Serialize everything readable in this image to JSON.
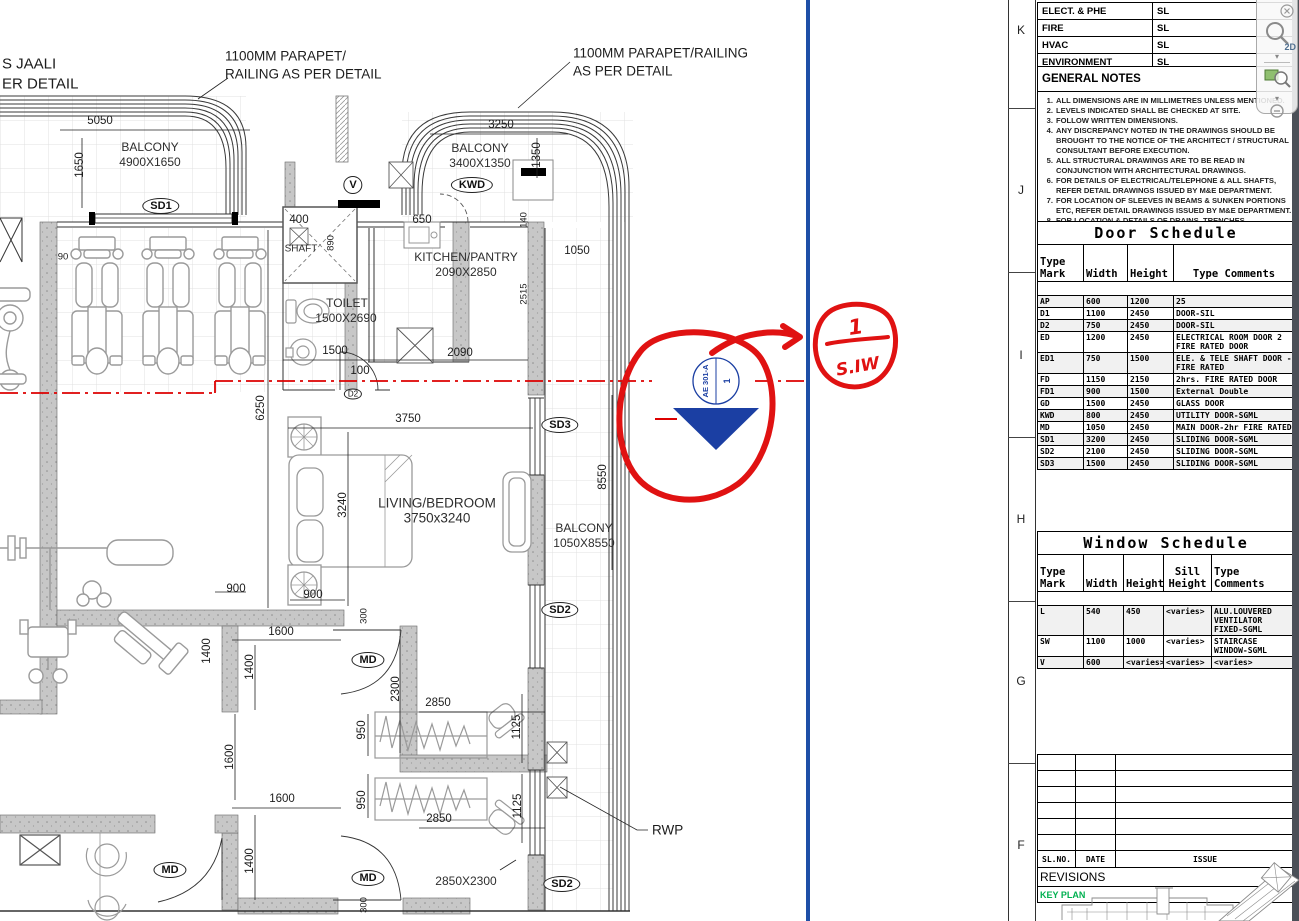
{
  "plan": {
    "labels": [
      "S JAALI",
      "ER DETAIL",
      "1100MM PARAPET/",
      "RAILING AS PER DETAIL",
      "1100MM PARAPET/RAILING",
      "AS PER DETAIL",
      "5050",
      "BALCONY",
      "4900X1650",
      "1650",
      "BALCONY",
      "3400X1350",
      "3250",
      "1350",
      "650",
      "400",
      "SHAFT",
      "890",
      "KITCHEN/PANTRY",
      "2090X2850",
      "1050",
      "140",
      "2515",
      "TOILET",
      "1500X2690",
      "1500",
      "100",
      "2090",
      "90",
      "6250",
      "3750",
      "LIVING/BEDROOM",
      "3750x3240",
      "3240",
      "8550",
      "BALCONY",
      "1050X8550",
      "900",
      "900",
      "1400",
      "1600",
      "1400",
      "1600",
      "1600",
      "1400",
      "2300",
      "2850",
      "950",
      "1125",
      "950",
      "2850",
      "1125",
      "300",
      "300",
      "2850X2300",
      "RWP"
    ],
    "tags": [
      "SD1",
      "V",
      "KWD",
      "D2",
      "SD3",
      "SD2",
      "MD",
      "MD",
      "MD",
      "SD2"
    ]
  },
  "section_marker": {
    "number": "1",
    "sheet_ref": "AE 301-A"
  },
  "markup": {
    "detail_number": "1",
    "sheet_note": "S.IW"
  },
  "nav_toolbar": {
    "wheel_label": "2D"
  },
  "sheet": {
    "grid_letters": [
      "K",
      "J",
      "I",
      "H",
      "G",
      "F"
    ],
    "consultant_table": {
      "rows": [
        {
          "label": "ELECT. & PHE",
          "value": "SL"
        },
        {
          "label": "FIRE",
          "value": "SL"
        },
        {
          "label": "HVAC",
          "value": "SL"
        },
        {
          "label": "ENVIRONMENT",
          "value": "SL"
        }
      ]
    },
    "general_notes": {
      "title": "GENERAL NOTES",
      "items": [
        "ALL DIMENSIONS ARE IN MILLIMETRES UNLESS MENTIONED.",
        "LEVELS INDICATED SHALL BE CHECKED AT SITE.",
        "FOLLOW WRITTEN DIMENSIONS.",
        "ANY DISCREPANCY NOTED IN THE DRAWINGS SHOULD BE BROUGHT TO THE NOTICE OF THE ARCHITECT / STRUCTURAL CONSULTANT BEFORE EXECUTION.",
        "ALL STRUCTURAL DRAWINGS ARE TO BE READ IN CONJUNCTION WITH ARCHITECTURAL DRAWINGS.",
        "FOR DETAILS OF ELECTRICAL/TELEPHONE & ALL SHAFTS, REFER DETAIL DRAWINGS ISSUED BY M&E DEPARTMENT.",
        "FOR LOCATION OF SLEEVES IN BEAMS & SUNKEN PORTIONS ETC,  REFER DETAIL DRAWINGS ISSUED BY M&E DEPARTMENT.",
        "FOR LOCATION & DETAILS OF DRAINS, TRENCHES, MANHOLES ETC,  REFER DETAIL DRAWINGS ISSUED BY M&E DEPARTMENT."
      ]
    },
    "door_schedule": {
      "title": "Door Schedule",
      "headers": [
        "Type Mark",
        "Width",
        "Height",
        "Type Comments"
      ],
      "rows": [
        [
          "AP",
          "600",
          "1200",
          "25"
        ],
        [
          "D1",
          "1100",
          "2450",
          "DOOR-SIL"
        ],
        [
          "D2",
          "750",
          "2450",
          "DOOR-SIL"
        ],
        [
          "ED",
          "1200",
          "2450",
          "ELECTRICAL ROOM DOOR 2\nFIRE RATED DOOR"
        ],
        [
          "ED1",
          "750",
          "1500",
          "ELE. & TELE SHAFT DOOR -\nFIRE RATED"
        ],
        [
          "FD",
          "1150",
          "2150",
          "2hrs. FIRE RATED DOOR"
        ],
        [
          "FD1",
          "900",
          "1500",
          "External Double"
        ],
        [
          "GD",
          "1500",
          "2450",
          "GLASS DOOR"
        ],
        [
          "KWD",
          "800",
          "2450",
          "UTILITY DOOR-SGML"
        ],
        [
          "MD",
          "1050",
          "2450",
          "MAIN DOOR-2hr FIRE RATED"
        ],
        [
          "SD1",
          "3200",
          "2450",
          "SLIDING DOOR-SGML"
        ],
        [
          "SD2",
          "2100",
          "2450",
          "SLIDING DOOR-SGML"
        ],
        [
          "SD3",
          "1500",
          "2450",
          "SLIDING DOOR-SGML"
        ]
      ]
    },
    "window_schedule": {
      "title": "Window Schedule",
      "headers": [
        "Type Mark",
        "Width",
        "Height",
        "Sill Height",
        "Type Comments"
      ],
      "rows": [
        [
          "L",
          "540",
          "450",
          "<varies>",
          "ALU.LOUVERED\nVENTILATOR\nFIXED-SGML"
        ],
        [
          "SW",
          "1100",
          "1000",
          "<varies>",
          "STAIRCASE\nWINDOW-SGML"
        ],
        [
          "V",
          "600",
          "<varies>",
          "<varies>",
          "<varies>"
        ]
      ]
    },
    "revision_table": {
      "headers": [
        "SL.NO.",
        "DATE",
        "ISSUE"
      ],
      "label": "REVISIONS"
    },
    "key_plan": {
      "label": "KEY PLAN"
    }
  }
}
